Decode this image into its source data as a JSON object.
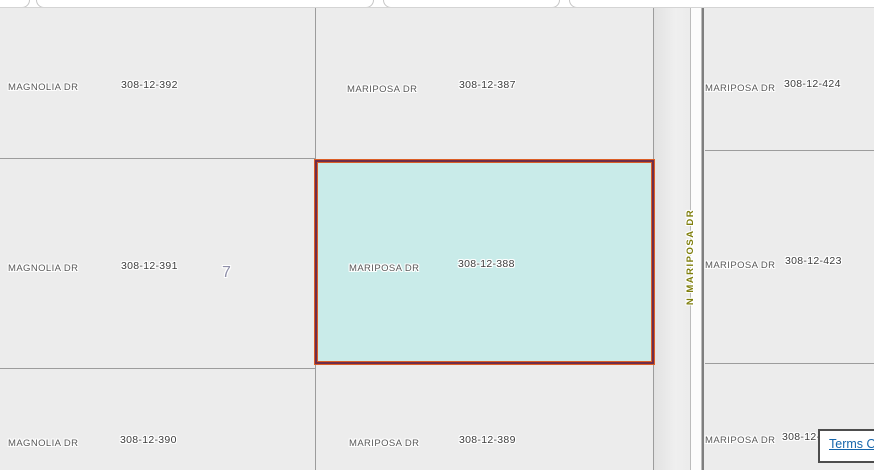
{
  "map": {
    "road_label": "N MARIPOSA DR",
    "section_label": "7",
    "parcels": [
      {
        "position": "top-left",
        "street": "MAGNOLIA DR",
        "apn": "308-12-392"
      },
      {
        "position": "top-middle",
        "street": "MARIPOSA DR",
        "apn": "308-12-387"
      },
      {
        "position": "top-right",
        "street": "MARIPOSA DR",
        "apn": "308-12-424"
      },
      {
        "position": "middle-left",
        "street": "MAGNOLIA DR",
        "apn": "308-12-391"
      },
      {
        "position": "middle-middle",
        "street": "MARIPOSA DR",
        "apn": "308-12-388",
        "selected": true
      },
      {
        "position": "middle-right",
        "street": "MARIPOSA DR",
        "apn": "308-12-423"
      },
      {
        "position": "bottom-left",
        "street": "MAGNOLIA DR",
        "apn": "308-12-390"
      },
      {
        "position": "bottom-middle",
        "street": "MARIPOSA DR",
        "apn": "308-12-389"
      },
      {
        "position": "bottom-right",
        "street": "MARIPOSA DR",
        "apn": "308-12-"
      }
    ],
    "colors": {
      "selected_fill": "#c9ebe9",
      "selected_outline_outer": "#dc5e26",
      "selected_outline_inner": "#6f2d49",
      "parcel_fill": "#ececec",
      "boundary_line": "#9c9c9c",
      "road_name_color": "#7e7e0c",
      "link_color": "#1565ab"
    }
  },
  "footer": {
    "terms_link": "Terms Of"
  }
}
